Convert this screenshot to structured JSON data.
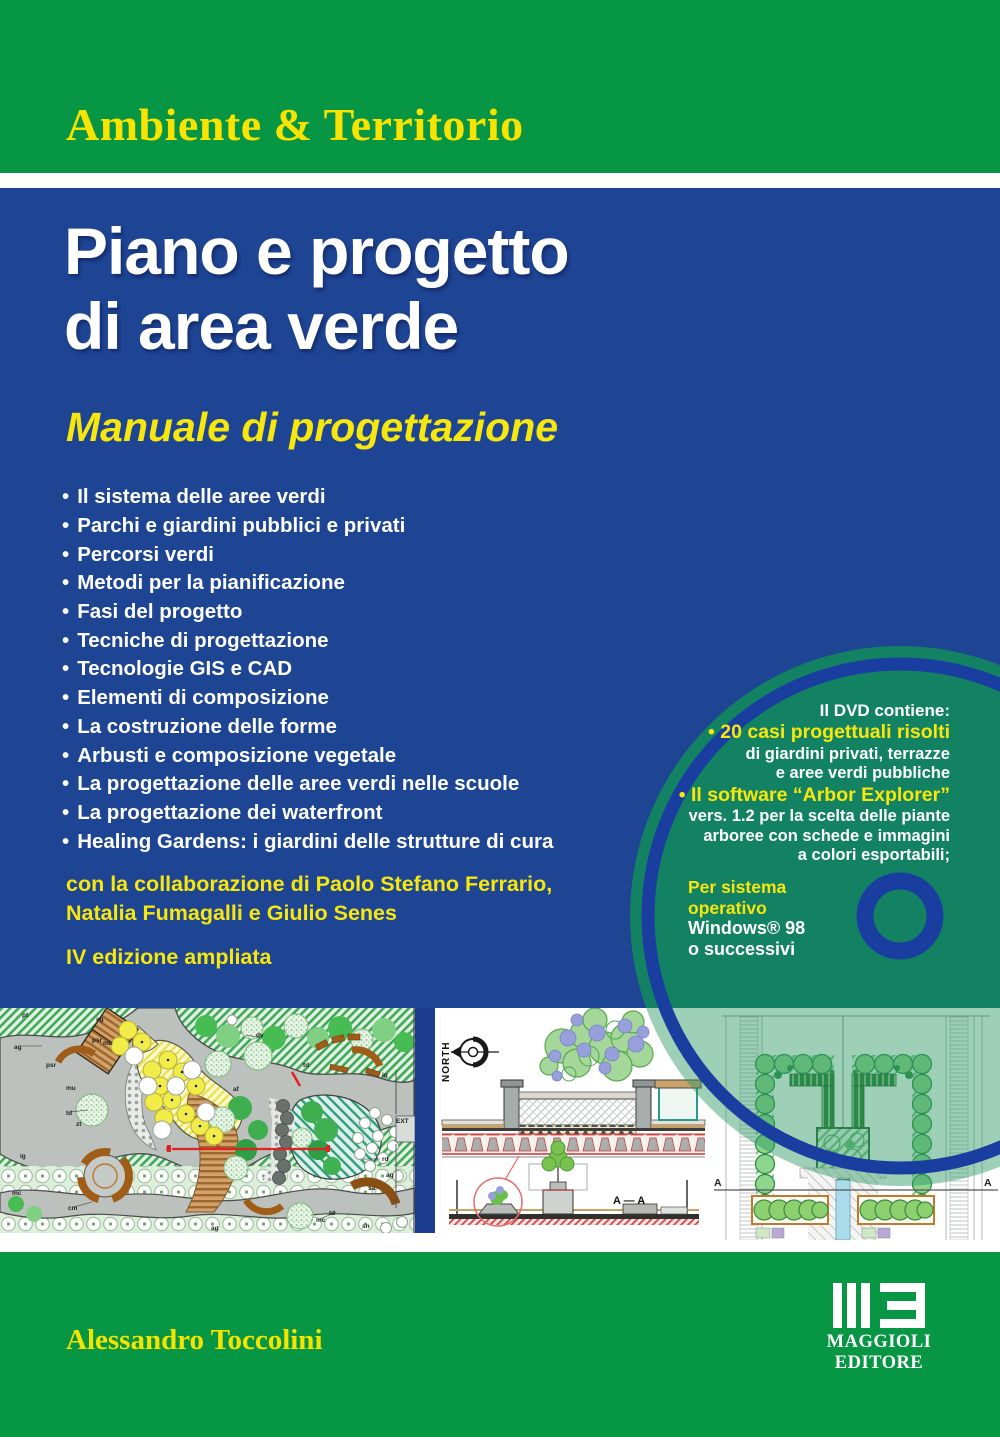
{
  "cover": {
    "series_title": "Ambiente & Territorio",
    "title_line1": "Piano e progetto",
    "title_line2": "di area verde",
    "subtitle": "Manuale di progettazione",
    "bullet_char": "•",
    "bullets": [
      "Il sistema delle aree verdi",
      "Parchi e giardini pubblici e privati",
      "Percorsi verdi",
      "Metodi per la pianificazione",
      "Fasi del progetto",
      "Tecniche di progettazione",
      "Tecnologie GIS e CAD",
      "Elementi di composizione",
      "La costruzione delle forme",
      "Arbusti e composizione vegetale",
      "La progettazione delle aree verdi nelle scuole",
      "La progettazione dei waterfront",
      "Healing Gardens: i giardini delle strutture di cura"
    ],
    "collaboration_lines": [
      "con la collaborazione di Paolo Stefano Ferrario,",
      "Natalia Fumagalli e Giulio Senes"
    ],
    "edition": "IV edizione ampliata"
  },
  "dvd": {
    "lines": [
      {
        "text": "Il DVD contiene:",
        "style": "dvd-head"
      },
      {
        "text": "• 20 casi progettuali risolti",
        "style": "dvd-yellow"
      },
      {
        "text": "di giardini privati, terrazze",
        "style": "dvd-white"
      },
      {
        "text": "e aree verdi pubbliche",
        "style": "dvd-white"
      },
      {
        "text": "• Il software “Arbor Explorer”",
        "style": "dvd-yellow"
      },
      {
        "text": "vers. 1.2 per la scelta delle piante",
        "style": "dvd-white"
      },
      {
        "text": "arboree con schede e immagini",
        "style": "dvd-white"
      },
      {
        "text": "a colori esportabili;",
        "style": "dvd-white"
      }
    ],
    "os_lines": [
      {
        "text": "Per sistema",
        "style": "os-yellow"
      },
      {
        "text": "operativo",
        "style": "os-yellow"
      },
      {
        "text": "Windows® 98",
        "style": "os-white"
      },
      {
        "text": "o successivi",
        "style": "os-white"
      }
    ]
  },
  "panels": {
    "left_plan": {
      "labels": [
        "pt",
        "ag",
        "psr",
        "mu",
        "td",
        "zt",
        "ig",
        "mc",
        "cm",
        "ag",
        "psr",
        "mu",
        "dv",
        "td",
        "af",
        "ig",
        "rd",
        "ag",
        "sa",
        "td",
        "mc",
        "ag",
        "sn",
        "EXT",
        "D",
        "D"
      ]
    },
    "middle": {
      "north_label": "NORTH",
      "section_label": "A — A"
    },
    "right": {
      "section_left": "A",
      "section_right": "A"
    }
  },
  "footer": {
    "author": "Alessandro Toccolini",
    "publisher_line1": "MAGGIOLI",
    "publisher_line2": "EDITORE"
  },
  "colors": {
    "band_green": "#079643",
    "cover_blue": "#1e4494",
    "accent_yellow": "#f8e400",
    "disc_green": "#128263",
    "ring_blue": "#1a3ea0"
  }
}
